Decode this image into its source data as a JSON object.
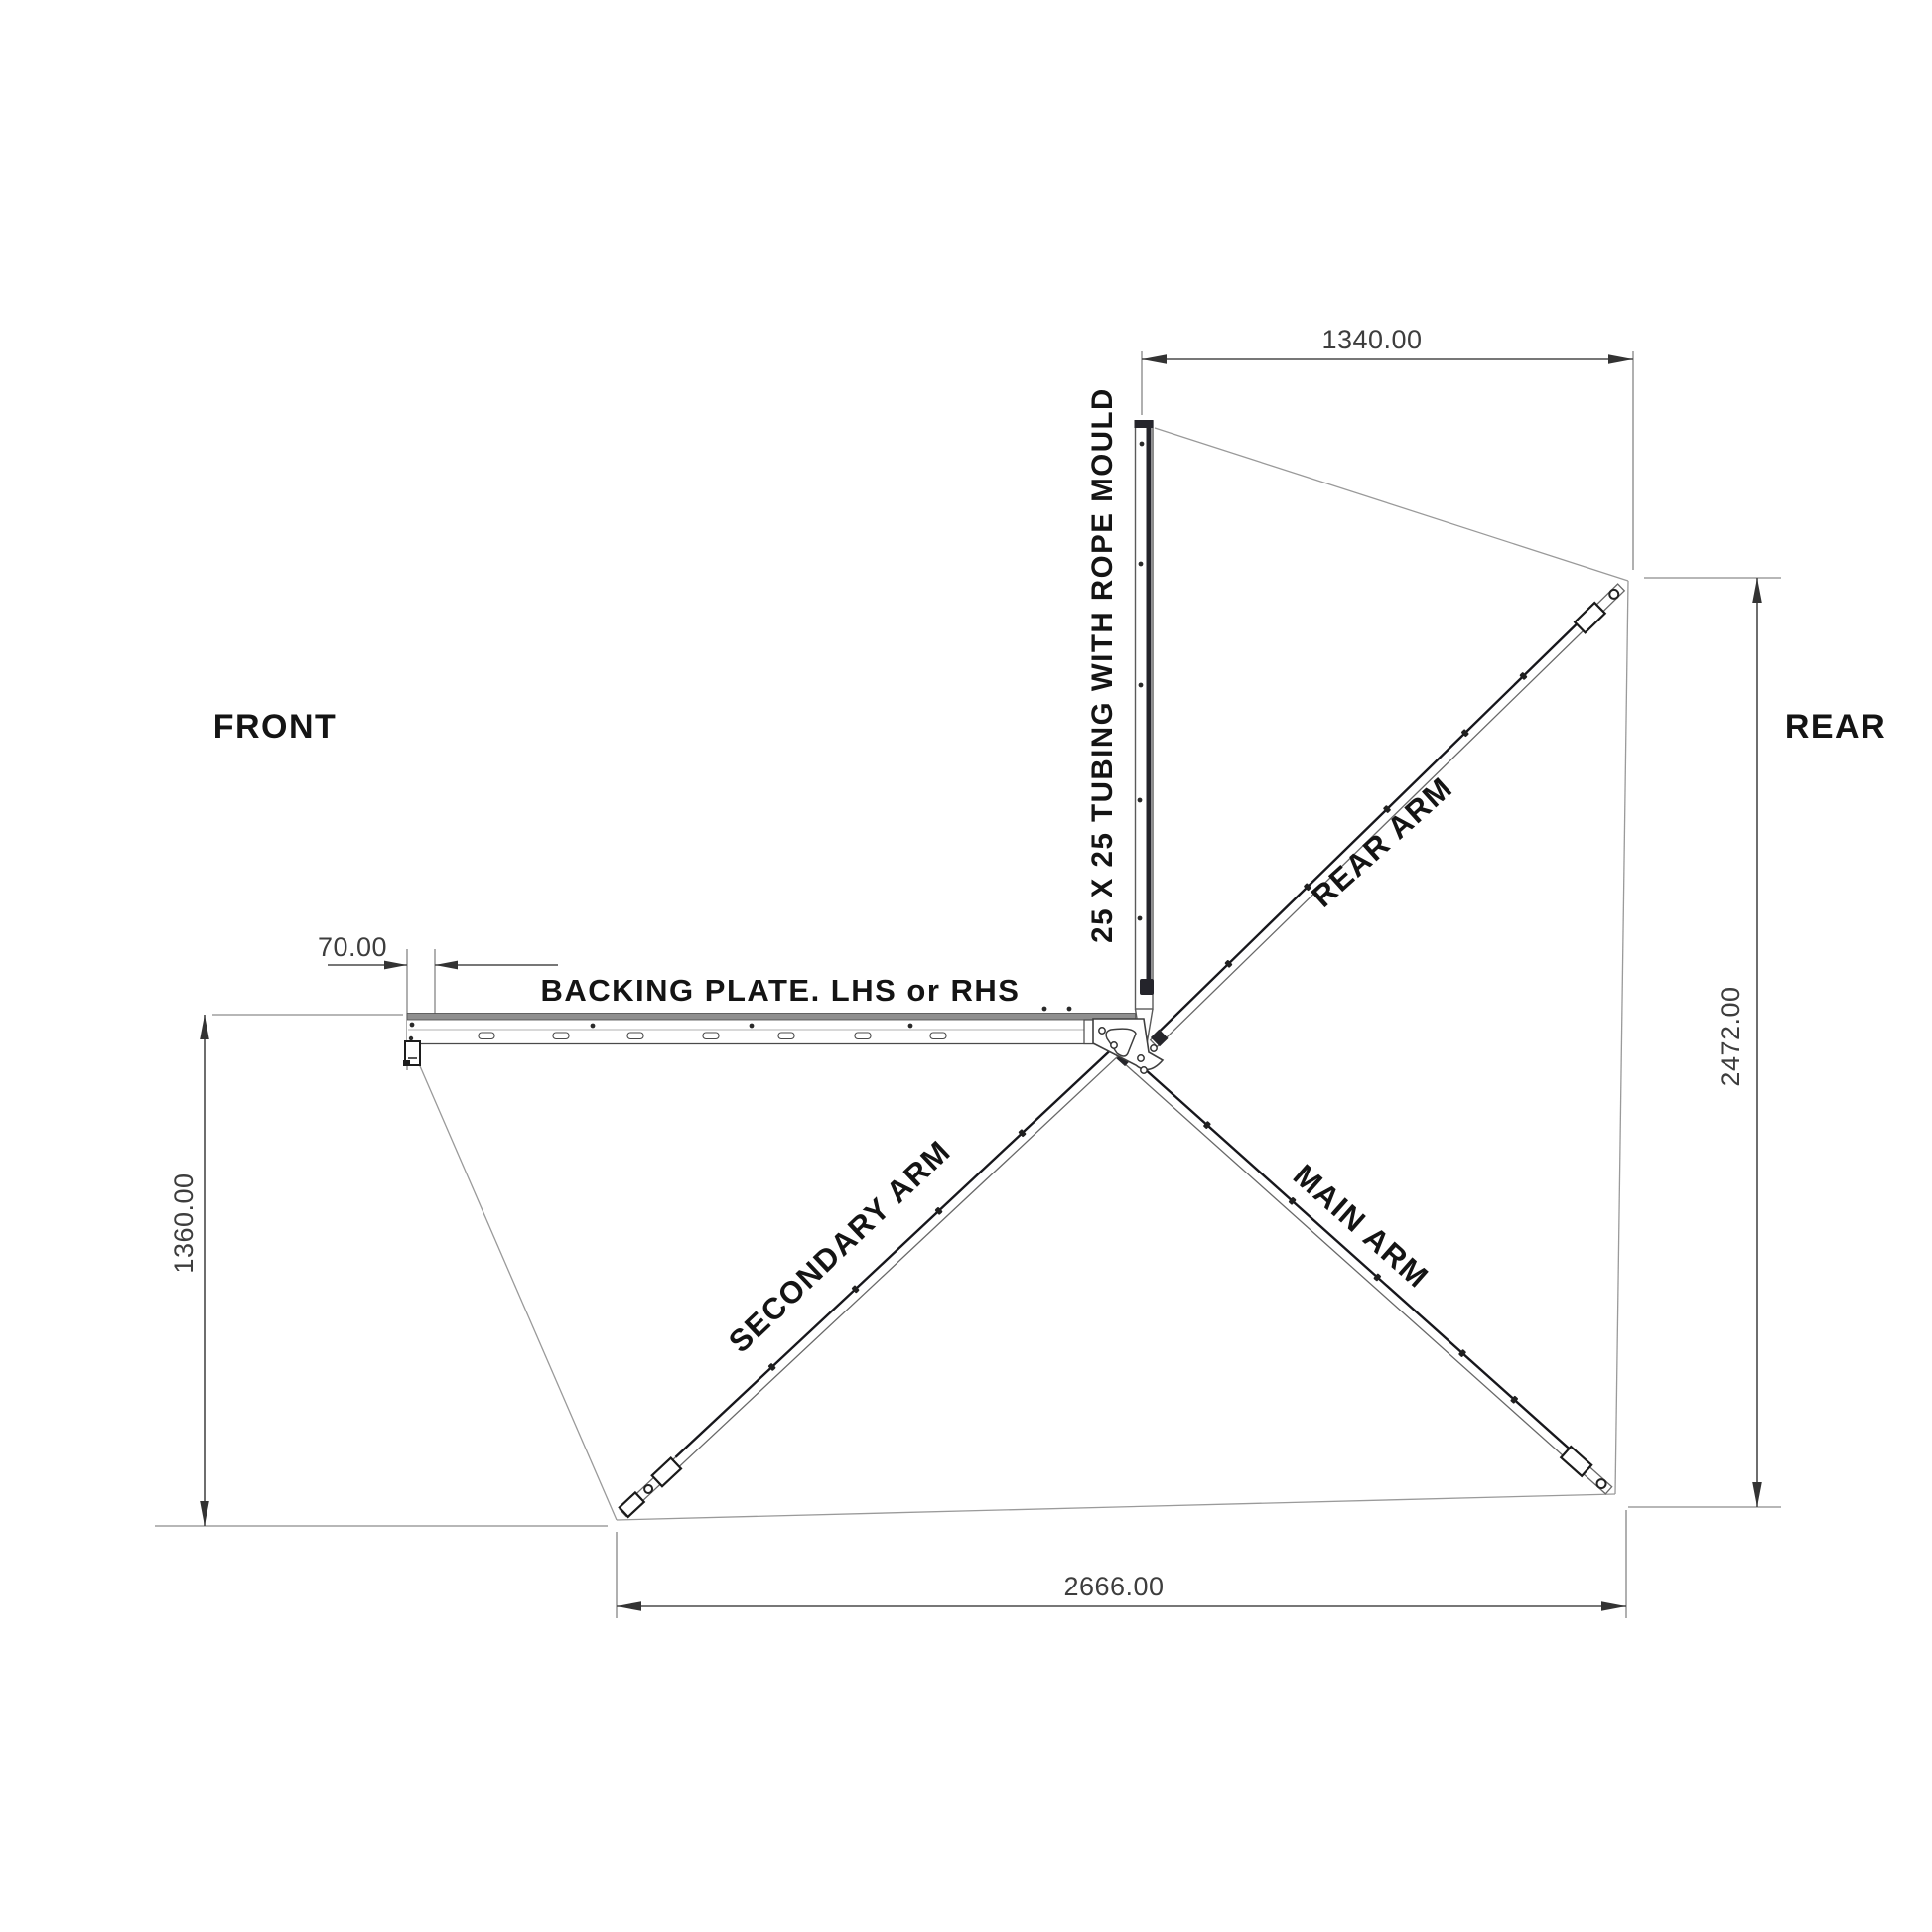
{
  "drawing": {
    "orientation": {
      "front": "FRONT",
      "rear": "REAR"
    },
    "dimensions": {
      "tube_width": "1340.00",
      "plate_offset": "70.00",
      "front_extent": "1360.00",
      "rear_extent": "2472.00",
      "bottom_span": "2666.00"
    },
    "parts": {
      "tube": "25 X 25 TUBING WITH ROPE MOULD",
      "backing_plate": "BACKING PLATE. LHS or RHS",
      "rear_arm": "REAR ARM",
      "main_arm": "MAIN ARM",
      "secondary_arm": "SECONDARY ARM"
    },
    "colors": {
      "background": "#ffffff",
      "dimension_line": "#4a4a4a",
      "fabric_line": "#9a9a9a",
      "arm_accent": "#17171c",
      "label_text": "#141414",
      "dimension_text": "#3d3d3d"
    }
  }
}
